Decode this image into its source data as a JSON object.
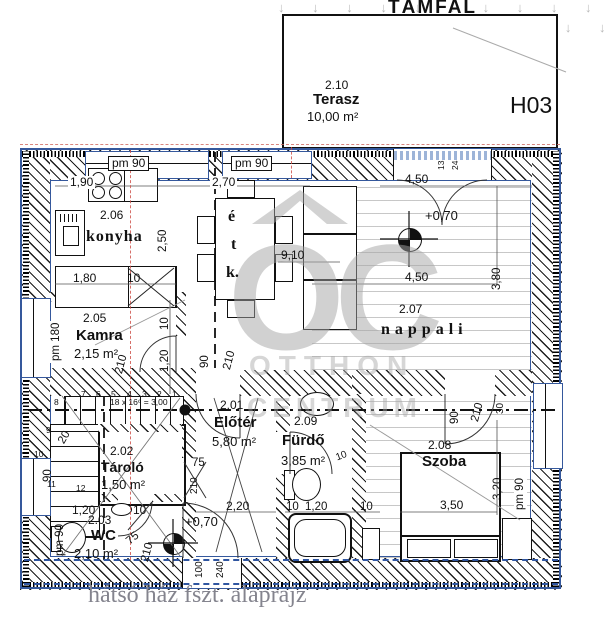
{
  "title": "TÁMFAL",
  "plan_caption": "hátsó ház fszt. alaprajz",
  "unit": "H03",
  "arrows_row": "↓ ↓ ↓ ↓ ↓ ↓ ↓ ↓ ↓ ↓",
  "watermark": {
    "logo": "OC",
    "line1": "OTTHON",
    "line2": "CENTRUM"
  },
  "terrace": {
    "code": "2.10",
    "name": "Terasz",
    "area": "10,00 m²"
  },
  "rooms": {
    "konyha": {
      "code": "2.06",
      "name": "konyha"
    },
    "etkezo": {
      "letters": [
        "é",
        "t",
        "k."
      ]
    },
    "nappali": {
      "code": "2.07",
      "name": "nappali"
    },
    "kamra": {
      "code": "2.05",
      "name": "Kamra",
      "area": "2,15 m²"
    },
    "eloter": {
      "code": "2.01",
      "name": "Előtér",
      "area": "5,80 m²"
    },
    "furdo": {
      "code": "2.09",
      "name": "Fürdő",
      "area": "3,85 m²"
    },
    "tarolo": {
      "code": "2.02",
      "name": "Tároló",
      "area": "1,50 m²"
    },
    "wc": {
      "code": "2.03",
      "name": "WC",
      "area": "2,10 m²"
    },
    "szoba": {
      "code": "2.08",
      "name": "Szoba"
    }
  },
  "levels": {
    "nappali": "+0,70",
    "hall": "+0,70"
  },
  "dims": {
    "pm90": "pm 90",
    "pm180": "pm 180",
    "w190": "1,90",
    "w270": "2,70",
    "w250": "2,50",
    "w180": "1,80",
    "t10": "10",
    "t13": "13",
    "t24": "24",
    "t20": "20",
    "t30": "30",
    "t75": "75",
    "t90": "90",
    "t100": "100",
    "t120": "1,20",
    "t210": "210",
    "t220": "2,20",
    "t240": "240",
    "t320": "3,20",
    "t350": "3,50",
    "t380": "3,80",
    "t450": "4,50",
    "t910": "9,10"
  },
  "stairs": {
    "formula": "18 x 16⁶ = 3,00",
    "steps": [
      "1",
      "2",
      "3",
      "4",
      "5",
      "6",
      "7",
      "8",
      "9",
      "10",
      "11",
      "12"
    ]
  },
  "colors": {
    "wall_blue": "#35589c",
    "axis_red": "#cc4b43",
    "watermark": "#a8a8a8",
    "caption": "#84848e"
  }
}
